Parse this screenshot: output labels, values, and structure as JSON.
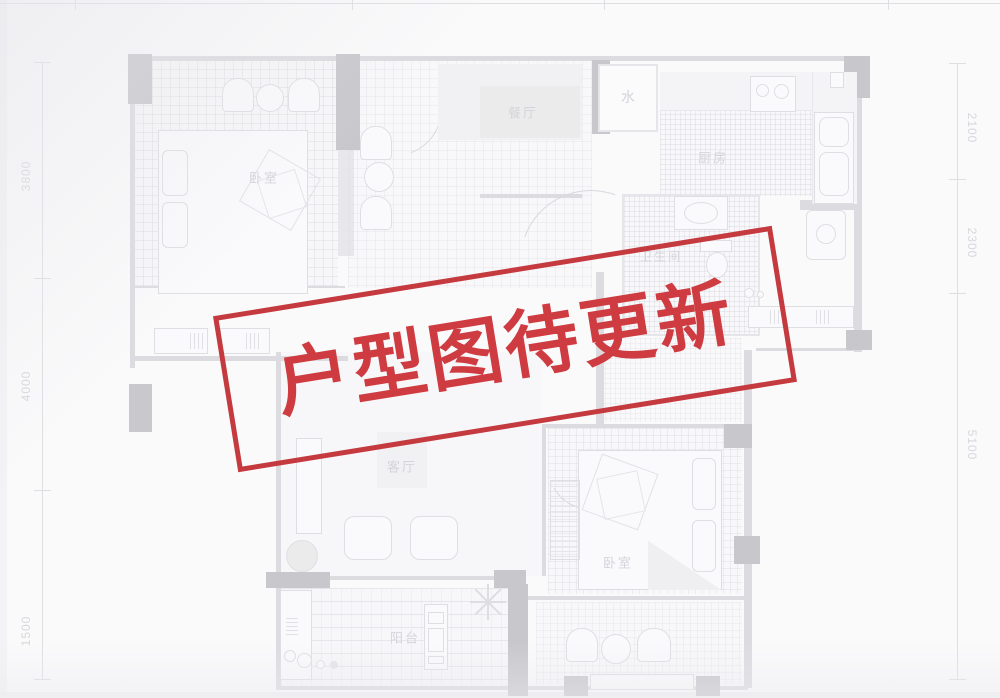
{
  "stamp": {
    "text": "户型图待更新",
    "text_color": "#ce3b40",
    "border_color": "#c43a3e"
  },
  "rooms": {
    "bedroom_top": {
      "label": "卧室"
    },
    "dining": {
      "label": "餐厅"
    },
    "water": {
      "label": "水"
    },
    "kitchen": {
      "label": "厨房"
    },
    "bathroom": {
      "label": "卫生间"
    },
    "living": {
      "label": "客厅"
    },
    "balcony": {
      "label": "阳台"
    },
    "bedroom_bottom": {
      "label": "卧室"
    }
  },
  "dimensions": {
    "left": [
      "3800",
      "4000",
      "1500"
    ],
    "right": [
      "2100",
      "2300",
      "5100"
    ]
  },
  "colors": {
    "background": "#fafafb",
    "plan_wall_dark": "#cacad0",
    "plan_wall_light": "#e1e1e5",
    "plan_label_gray": "#d8d8de",
    "stamp_red": "#ce3b40"
  }
}
